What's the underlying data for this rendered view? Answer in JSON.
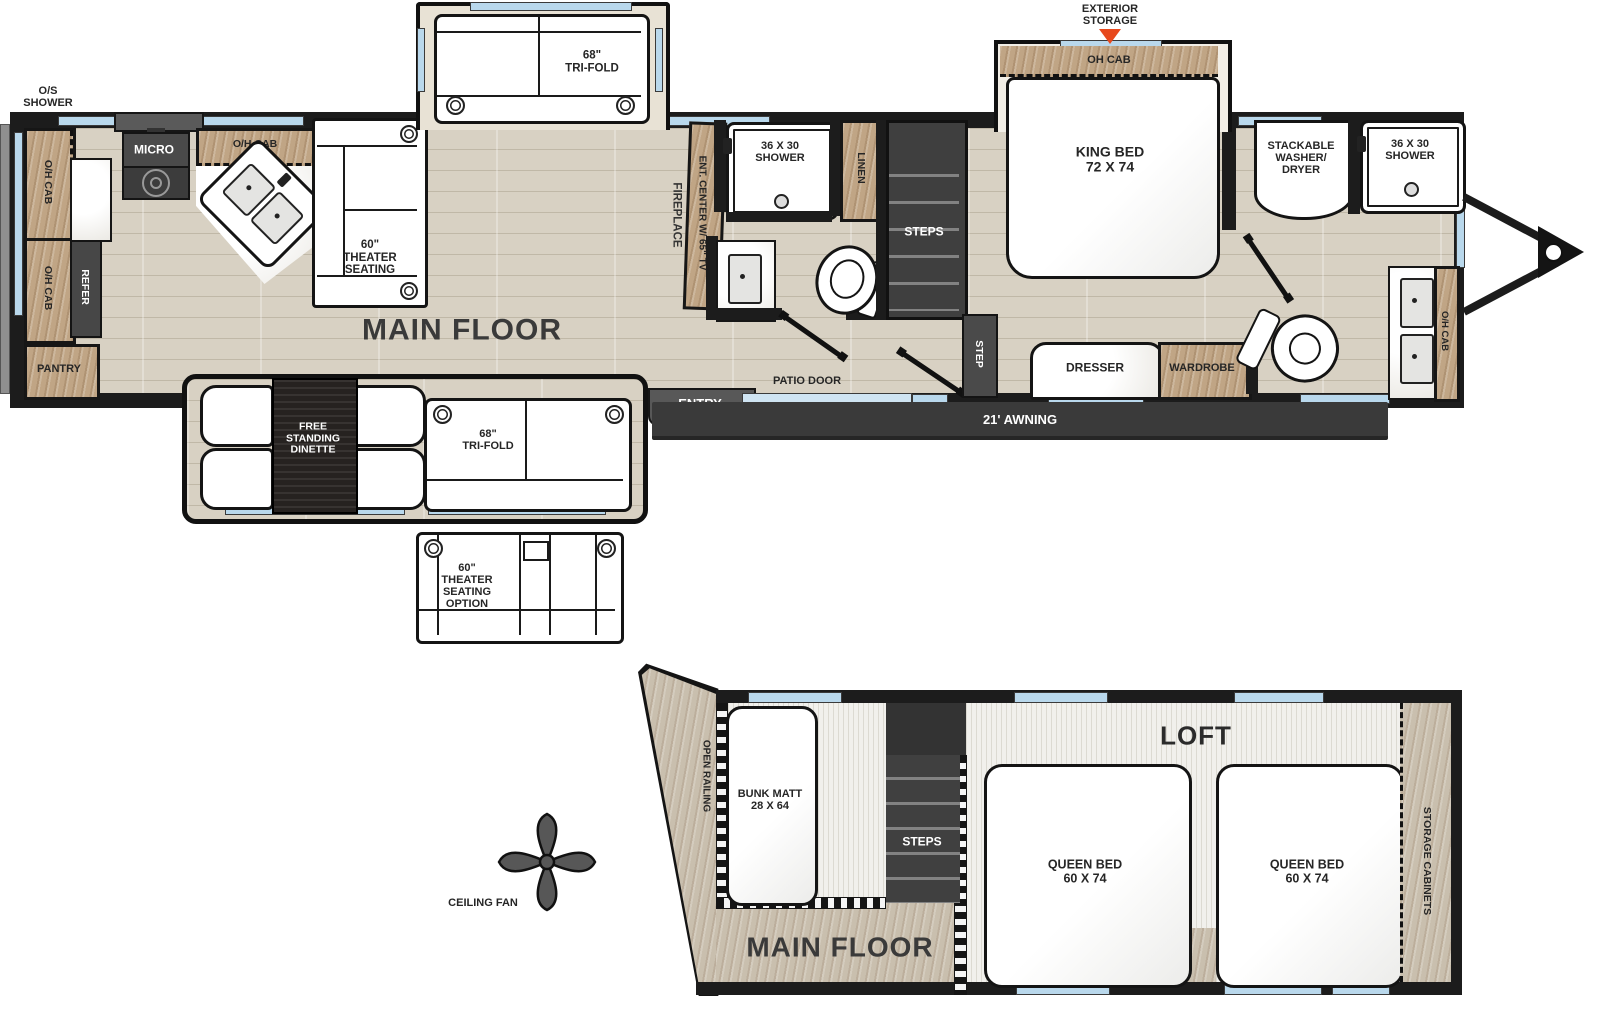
{
  "labels": {
    "os_shower": "O/S\nSHOWER",
    "oh_cab": "O/H CAB",
    "micro": "MICRO",
    "refer": "REFER",
    "pantry": "PANTRY",
    "theater_seating_60": "60\"\nTHEATER\nSEATING",
    "tri_fold_68": "68\"\nTRI-FOLD",
    "main_floor": "MAIN FLOOR",
    "fireplace": "FIREPLACE",
    "ent_center": "ENT. CENTER W/ 65\" TV",
    "shower_36x30": "36 X 30\nSHOWER",
    "linen": "LINEN",
    "steps": "STEPS",
    "step": "STEP",
    "patio_door": "PATIO DOOR",
    "entry": "ENTRY",
    "exterior_storage": "EXTERIOR\nSTORAGE",
    "oh_cab_bed": "OH CAB",
    "king_bed": "KING BED\n72 X 74",
    "stackable_wd": "STACKABLE\nWASHER/\nDRYER",
    "dresser": "DRESSER",
    "wardrobe": "WARDROBE",
    "awning_21": "21' AWNING",
    "free_standing_dinette": "FREE\nSTANDING\nDINETTE",
    "theater_option_60": "60\"\nTHEATER\nSEATING\nOPTION",
    "ceiling_fan": "CEILING FAN",
    "open_railing": "OPEN RAILING",
    "bunk_matt": "BUNK MATT\n28 X 64",
    "loft": "LOFT",
    "queen_bed": "QUEEN BED\n60 X 74",
    "storage_cabinets": "STORAGE CABINETS"
  },
  "colors": {
    "wall": "#1c1c1c",
    "floor_wood": "#d8d1c3",
    "cabinet_wood": "#c0a585",
    "dark_fixture": "#474747",
    "window_blue": "#b9d8ec",
    "accent_orange": "#e8491d",
    "marble": "#f7f6f3"
  }
}
